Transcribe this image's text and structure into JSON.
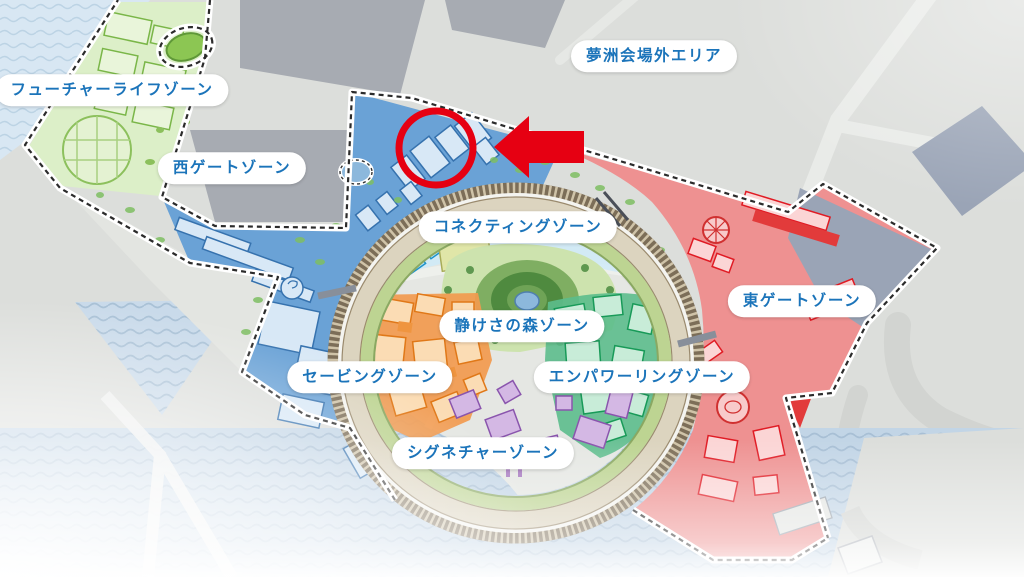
{
  "map": {
    "outside_area_label": "夢洲会場外エリア",
    "zone_labels": {
      "future_life": "フューチャーライフゾーン",
      "west_gate": "西ゲートゾーン",
      "connecting": "コネクティングゾーン",
      "east_gate": "東ゲートゾーン",
      "quiet_forest": "静けさの森ゾーン",
      "saving": "セービングゾーン",
      "empowering": "エンパワーリングゾーン",
      "signature": "シグネチャーゾーン"
    },
    "label_style": {
      "text_color": "#1b74ba",
      "background": "#ffffff"
    },
    "zone_colors": {
      "future_life": "#8cc653",
      "west_gate": "#6aa2d6",
      "connecting": "#45b8e8",
      "east_gate": "#ee9191",
      "quiet_forest": "#5f9850",
      "saving": "#ef9540",
      "empowering": "#2fa96e",
      "signature": "#a678bf",
      "grand_ring": "#dcd4bf"
    },
    "water_color": "#c2d5e6",
    "annotation": {
      "color": "#e60012",
      "shape": "circle",
      "pointer": "arrow-left",
      "circle_center_x": 436,
      "circle_center_y": 148,
      "circle_radius": 37
    }
  }
}
